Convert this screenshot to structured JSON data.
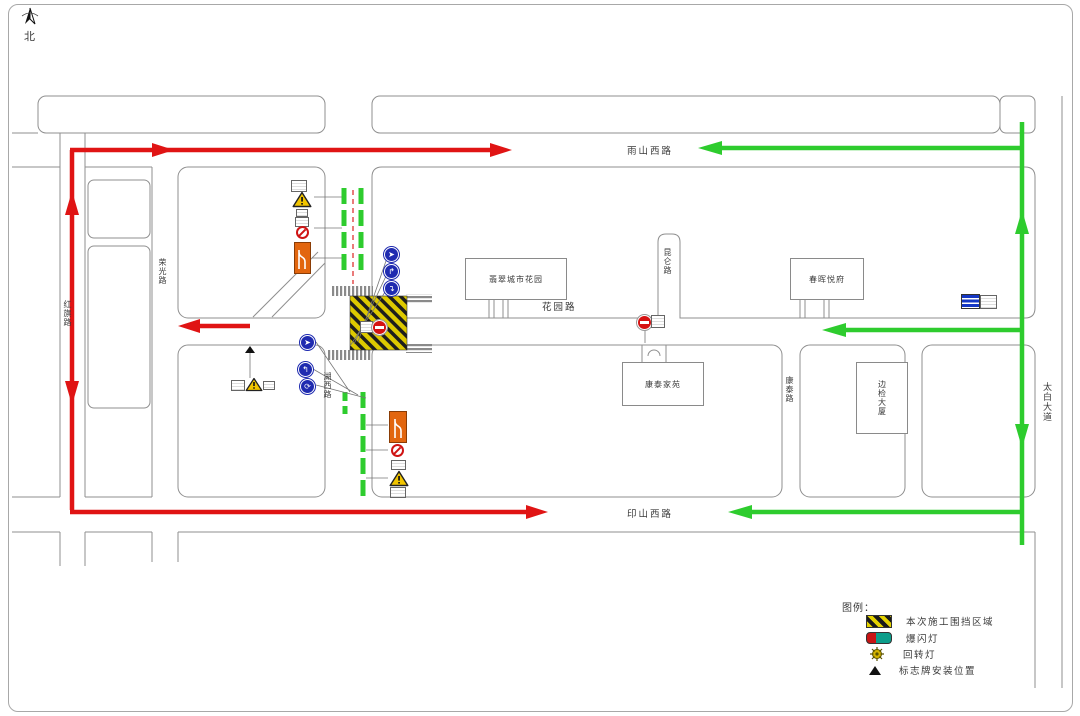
{
  "compass": {
    "north_label": "北"
  },
  "roads": {
    "yushan_west_road": "雨山西路",
    "yinshan_west_road": "印山西路",
    "huayuan_road": "花园路",
    "hongqi_road": "红旗路",
    "rongguang_road": "荣光路",
    "huxi_road": "湖西路",
    "kunlun_road": "昆仑路",
    "kangtai_road": "康泰路",
    "taibai_avenue": "太白大道"
  },
  "buildings": {
    "feicui_city_garden": "翡翠城市花园",
    "chunhui_yuefu": "春晖悦府",
    "kangtai_jiayuan": "康泰家苑",
    "bianjian_tower": "边检大厦"
  },
  "legend": {
    "title": "图例：",
    "items": [
      {
        "label": "本次施工围挡区域"
      },
      {
        "label": "爆闪灯"
      },
      {
        "label": "回转灯"
      },
      {
        "label": "标志牌安装位置"
      }
    ]
  },
  "colors": {
    "detour_route_red": "#e01414",
    "open_route_green": "#2ecc2e",
    "construction_zone_yellow": "#ddc900"
  }
}
